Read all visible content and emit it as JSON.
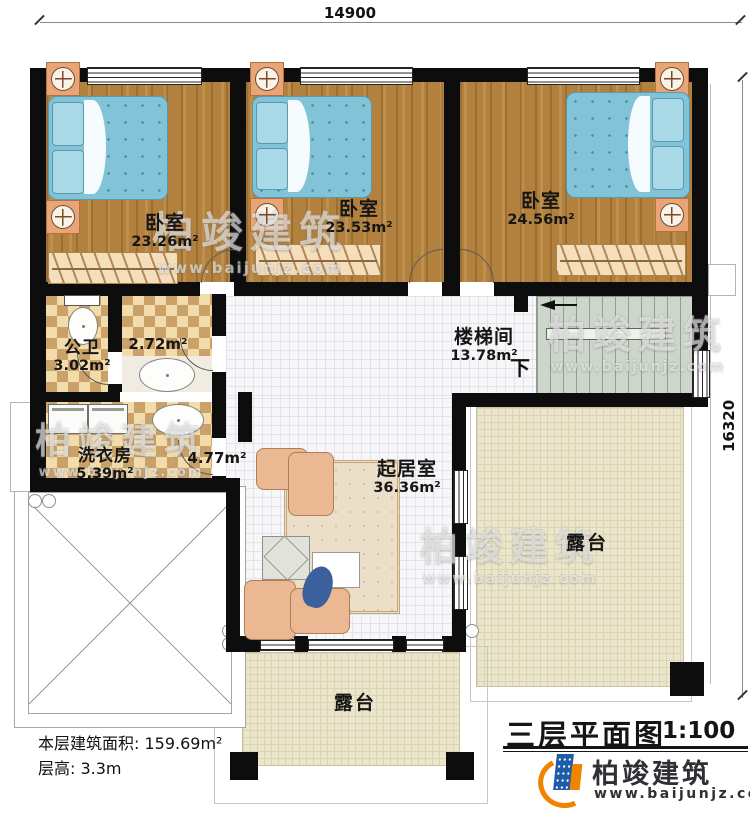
{
  "dimensions": {
    "top": "14900",
    "right": "16320"
  },
  "rooms": {
    "bedroom1": {
      "name": "卧室",
      "area": "23.26m²"
    },
    "bedroom2": {
      "name": "卧室",
      "area": "23.53m²"
    },
    "bedroom3": {
      "name": "卧室",
      "area": "24.56m²"
    },
    "bathroom": {
      "name": "公卫",
      "area": "3.02m²"
    },
    "vanity": {
      "area": "2.72m²"
    },
    "laundry": {
      "name": "洗衣房",
      "area": "5.39m²"
    },
    "hall": {
      "area": "4.77m²"
    },
    "living": {
      "name": "起居室",
      "area": "36.36m²"
    },
    "stairwell": {
      "name": "楼梯间",
      "area": "13.78m²",
      "direction": "下"
    },
    "terrace_right": {
      "name": "露台"
    },
    "terrace_bottom": {
      "name": "露台"
    }
  },
  "footer": {
    "area_label": "本层建筑面积: 159.69m²",
    "height_label": "层高: 3.3m"
  },
  "title_block": {
    "title": "三层平面图",
    "scale": "1:100"
  },
  "logo": {
    "name": "柏竣建筑",
    "url": "www.baijunjz.com"
  },
  "watermark": {
    "text": "柏竣建筑",
    "url": "www.baijunjz.com"
  },
  "colors": {
    "wall": "#0d0d0d",
    "wood": "#b3813e",
    "bed": "#83c3d8",
    "tile_checker": "#c9a169",
    "terrace": "#ebe6cb",
    "logo_blue": "#1d5ca6",
    "logo_orange": "#f08300"
  }
}
